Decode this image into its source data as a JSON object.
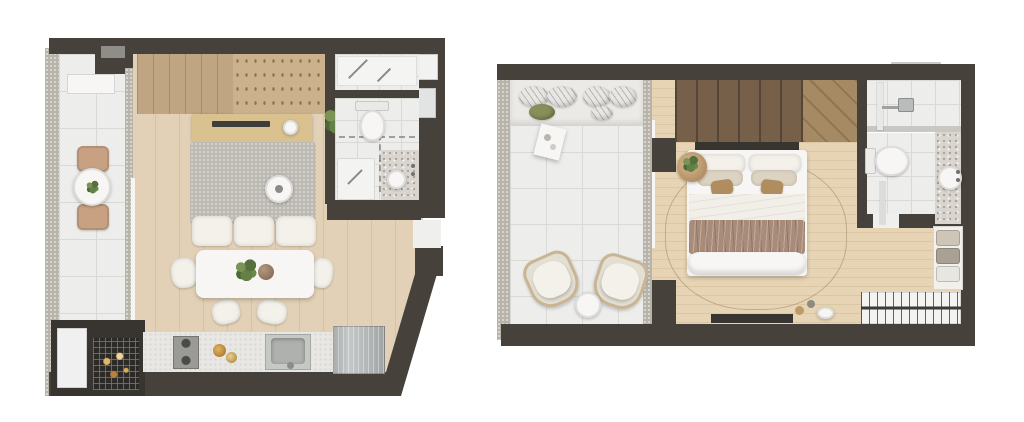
{
  "page": {
    "background": "#ffffff",
    "title": "Apartment floor plans, top-down rendered views"
  },
  "colors": {
    "wall": "#46413b",
    "wallDark": "#38342f",
    "tile": "#ededec",
    "tileLine": "#d9d9d6",
    "concrete": "#b8b4aa",
    "woodA": "#e2d1b6",
    "woodB": "#e6d4b4",
    "closetWood": "#c0a583",
    "closetShelf": "#cbb28d",
    "consoleWood": "#d9c28f",
    "sofaGray": "#bdbab3",
    "cushion": "#f3f1ea",
    "counter": "#e8e7e3",
    "tan": "#c8a183",
    "mauve": "#a98b79",
    "darkWood": "#76604a",
    "diagWood": "#a58a63",
    "fixtureWhite": "#f7f6f4"
  },
  "plans": [
    {
      "id": "living-kitchen",
      "label": "Studio plan: balcony, living-dining room, kitchen, barbecue nook and bathroom",
      "rooms": [
        "balcony",
        "living-dining",
        "kitchen",
        "bathroom",
        "barbecue-nook",
        "entry"
      ],
      "furniture": [
        "balcony round table with plant",
        "two balcony chairs",
        "wardrobe with shelving",
        "console desk with laptop",
        "sofa bed with three cushions",
        "round side table",
        "dining table with plant centerpiece",
        "four dining chairs",
        "cooktop",
        "kitchen sink",
        "fridge",
        "charcoal grill",
        "washer",
        "toilet",
        "vanity-bathtub",
        "shower"
      ]
    },
    {
      "id": "bedroom",
      "label": "Suite plan: balcony lounge, bedroom, closet wall and bathroom",
      "rooms": [
        "balcony-lounge",
        "bedroom",
        "closet",
        "bathroom"
      ],
      "furniture": [
        "outdoor sofa with pillows",
        "coffee table",
        "two armchairs",
        "round side table",
        "wardrobe",
        "double bed with throw blanket",
        "round nightstand with plant",
        "area rug",
        "tv bench",
        "clothes rack",
        "shelf with baskets",
        "shower",
        "toilet",
        "round basin"
      ]
    }
  ]
}
